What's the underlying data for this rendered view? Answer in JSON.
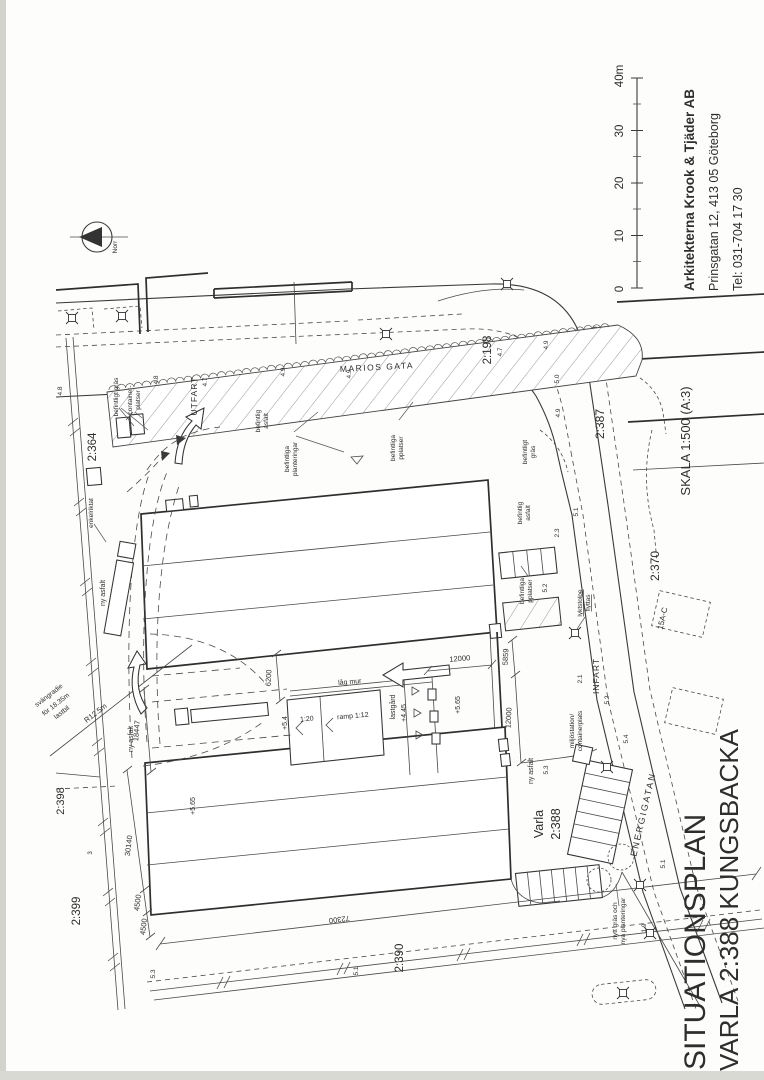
{
  "page": {
    "bg": "#fdfdfb",
    "ink": "#3a3a3a",
    "kind": "architectural site plan (scanned, rotated 90°)"
  },
  "scale_bar": {
    "unit_labels": [
      "0",
      "10",
      "20",
      "30",
      "40m"
    ],
    "length_m": 40
  },
  "texts": [
    {
      "n": "firm-name",
      "t": "Arkitekterna Krook & Tjäder AB",
      "x": 694,
      "y": 291,
      "r": -90,
      "s": 13.5,
      "a": "s",
      "w": 1
    },
    {
      "n": "firm-address",
      "t": "Prinsgatan 12,  413 05 Göteborg",
      "x": 718,
      "y": 291,
      "r": -90,
      "s": 12.5,
      "a": "s"
    },
    {
      "n": "firm-phone",
      "t": "Tel: 031-704 17 30",
      "x": 742,
      "y": 291,
      "r": -90,
      "s": 12.5,
      "a": "s"
    },
    {
      "n": "scale-note",
      "t": "SKALA 1:500 (A:3)",
      "x": 690,
      "y": 441,
      "r": -90,
      "s": 13
    },
    {
      "n": "title-line1",
      "t": "SITUATIONSPLAN",
      "x": 705,
      "y": 1070,
      "r": -90,
      "s": 30,
      "a": "s"
    },
    {
      "n": "title-line2",
      "t": "VARLA 2:388  KUNGSBACKA",
      "x": 738,
      "y": 1071,
      "r": -90,
      "s": 26,
      "a": "s"
    },
    {
      "n": "scalebar-0",
      "t": "0",
      "x": 623,
      "y": 289,
      "r": -90,
      "s": 11.5
    },
    {
      "n": "scalebar-10",
      "t": "10",
      "x": 623,
      "y": 236,
      "r": -90,
      "s": 11.5
    },
    {
      "n": "scalebar-20",
      "t": "20",
      "x": 623,
      "y": 183,
      "r": -90,
      "s": 11.5
    },
    {
      "n": "scalebar-30",
      "t": "30",
      "x": 623,
      "y": 131,
      "r": -90,
      "s": 11.5
    },
    {
      "n": "scalebar-40",
      "t": "40m",
      "x": 623,
      "y": 76,
      "r": -90,
      "s": 11.5
    },
    {
      "n": "north-label",
      "t": "Norr",
      "x": 117,
      "y": 247,
      "r": -90,
      "s": 6.5
    },
    {
      "n": "street-marios-gata",
      "t": "MARIOS GATA",
      "x": 340,
      "y": 372,
      "r": -3,
      "s": 8.5,
      "a": "s",
      "ls": 1.5
    },
    {
      "n": "street-energigatan",
      "t": "ENERGIGATAN",
      "x": 646,
      "y": 815,
      "r": -77,
      "s": 9,
      "ls": 2
    },
    {
      "n": "label-utfart",
      "t": "UTFART",
      "x": 197,
      "y": 396,
      "r": -90,
      "s": 8.5,
      "ls": 1
    },
    {
      "n": "label-infart",
      "t": "INFART",
      "x": 599,
      "y": 676,
      "r": -90,
      "s": 8.5,
      "ls": 1
    },
    {
      "n": "parcel-2364",
      "t": "2:364",
      "x": 96,
      "y": 447,
      "r": -90,
      "s": 11.5
    },
    {
      "n": "parcel-2198",
      "t": "2:198",
      "x": 491,
      "y": 350,
      "r": -90,
      "s": 11.5
    },
    {
      "n": "parcel-2387",
      "t": "2:387",
      "x": 604,
      "y": 424,
      "r": -90,
      "s": 12
    },
    {
      "n": "parcel-2370",
      "t": "2:370",
      "x": 659,
      "y": 566,
      "r": -90,
      "s": 12
    },
    {
      "n": "parcel-2398",
      "t": "2:398",
      "x": 64,
      "y": 801,
      "r": -90,
      "s": 11
    },
    {
      "n": "parcel-2399",
      "t": "2:399",
      "x": 80,
      "y": 911,
      "r": -90,
      "s": 11.5
    },
    {
      "n": "parcel-2390",
      "t": "2:390",
      "x": 403,
      "y": 958,
      "r": -90,
      "s": 11.5
    },
    {
      "n": "parcel-varla-1",
      "t": "Varla",
      "x": 543,
      "y": 824,
      "r": -90,
      "s": 12.5
    },
    {
      "n": "parcel-varla-2",
      "t": "2:388",
      "x": 560,
      "y": 824,
      "r": -90,
      "s": 12.5
    },
    {
      "n": "building-15ac",
      "t": "15A-C",
      "x": 665,
      "y": 619,
      "r": -77,
      "s": 8
    },
    {
      "n": "note-befintligt-gras-1",
      "t": "befintligt gräs",
      "x": 118,
      "y": 397,
      "r": -90,
      "s": 6.5
    },
    {
      "n": "note-container-1",
      "t": "container-",
      "x": 132,
      "y": 400,
      "r": -90,
      "s": 6.5
    },
    {
      "n": "note-container-2",
      "t": "platser",
      "x": 140,
      "y": 400,
      "r": -90,
      "s": 6.5
    },
    {
      "n": "note-bef-asfalt-1a",
      "t": "befintlig",
      "x": 260,
      "y": 421,
      "r": -90,
      "s": 6.5
    },
    {
      "n": "note-bef-asfalt-1b",
      "t": "asfalt",
      "x": 268,
      "y": 421,
      "r": -90,
      "s": 6.5
    },
    {
      "n": "note-bef-plant-1a",
      "t": "befintliga",
      "x": 289,
      "y": 459,
      "r": -90,
      "s": 6.5
    },
    {
      "n": "note-bef-plant-1b",
      "t": "planteringar",
      "x": 297,
      "y": 459,
      "r": -90,
      "s": 6.5
    },
    {
      "n": "note-bef-pplatser-1a",
      "t": "befintliga",
      "x": 395,
      "y": 448,
      "r": -90,
      "s": 6.5
    },
    {
      "n": "note-bef-pplatser-1b",
      "t": "pplatser",
      "x": 403,
      "y": 448,
      "r": -90,
      "s": 6.5
    },
    {
      "n": "note-befintligt-gras-2a",
      "t": "befintligt",
      "x": 527,
      "y": 452,
      "r": -90,
      "s": 6.5
    },
    {
      "n": "note-befintligt-gras-2b",
      "t": "gräs",
      "x": 535,
      "y": 452,
      "r": -90,
      "s": 6.5
    },
    {
      "n": "note-bef-asfalt-2a",
      "t": "befintlig",
      "x": 522,
      "y": 513,
      "r": -90,
      "s": 6.5
    },
    {
      "n": "note-bef-asfalt-2b",
      "t": "asfalt",
      "x": 530,
      "y": 513,
      "r": -90,
      "s": 6.5
    },
    {
      "n": "note-bef-pplatser-2a",
      "t": "befintliga",
      "x": 524,
      "y": 591,
      "r": -90,
      "s": 6.5
    },
    {
      "n": "note-bef-pplatser-2b",
      "t": "pplatser",
      "x": 532,
      "y": 591,
      "r": -90,
      "s": 6.5
    },
    {
      "n": "note-lyktstolpe-1",
      "t": "lyktstolpe",
      "x": 582,
      "y": 603,
      "r": -90,
      "s": 6.5,
      "u": 1
    },
    {
      "n": "note-lyktstolpe-2",
      "t": "flyttas",
      "x": 590,
      "y": 603,
      "r": -90,
      "s": 6.5,
      "u": 1
    },
    {
      "n": "note-miljostation-1",
      "t": "miljöstation/",
      "x": 574,
      "y": 731,
      "r": -90,
      "s": 6.5
    },
    {
      "n": "note-miljostation-2",
      "t": "containerplats",
      "x": 582,
      "y": 731,
      "r": -90,
      "s": 6.5
    },
    {
      "n": "note-nytt-gras-1",
      "t": "nytt gräs och",
      "x": 617,
      "y": 921,
      "r": -90,
      "s": 6.5
    },
    {
      "n": "note-nytt-gras-2",
      "t": "nya planteringar",
      "x": 625,
      "y": 921,
      "r": -90,
      "s": 6.5
    },
    {
      "n": "note-enkelriktat",
      "t": "enkelriktat",
      "x": 93,
      "y": 513,
      "r": -90,
      "s": 6.5
    },
    {
      "n": "note-ny-asfalt-1",
      "t": "ny asfalt",
      "x": 105,
      "y": 593,
      "r": -90,
      "s": 7
    },
    {
      "n": "note-ny-asfalt-2",
      "t": "ny asfalt",
      "x": 133,
      "y": 739,
      "r": -90,
      "s": 7
    },
    {
      "n": "note-ny-asfalt-3",
      "t": "ny asfalt",
      "x": 533,
      "y": 771,
      "r": -90,
      "s": 7
    },
    {
      "n": "note-lag-mur",
      "t": "låg mur",
      "x": 350,
      "y": 684,
      "r": -5,
      "s": 7
    },
    {
      "n": "note-ramp",
      "t": "ramp 1:12",
      "x": 353,
      "y": 718,
      "r": -5,
      "s": 7
    },
    {
      "n": "note-slope-120",
      "t": "1:20",
      "x": 307,
      "y": 721,
      "r": -5,
      "s": 7
    },
    {
      "n": "note-lastgard",
      "t": "lastgård",
      "x": 395,
      "y": 707,
      "r": -90,
      "s": 7
    },
    {
      "n": "level-445",
      "t": "+4.45",
      "x": 406,
      "y": 713,
      "r": -90,
      "s": 7
    },
    {
      "n": "level-565-a",
      "t": "+5.65",
      "x": 460,
      "y": 705,
      "r": -90,
      "s": 7
    },
    {
      "n": "level-54",
      "t": "+5.4",
      "x": 287,
      "y": 723,
      "r": -90,
      "s": 7
    },
    {
      "n": "level-565-b",
      "t": "+5.65",
      "x": 195,
      "y": 806,
      "r": -90,
      "s": 7
    },
    {
      "n": "note-svangradie-1",
      "t": "svängradie",
      "x": 50,
      "y": 697,
      "r": -38,
      "s": 6.8
    },
    {
      "n": "note-svangradie-2",
      "t": "för 18.35m",
      "x": 57,
      "y": 706,
      "r": -38,
      "s": 6.8
    },
    {
      "n": "note-svangradie-3",
      "t": "lastbil",
      "x": 63,
      "y": 714,
      "r": -38,
      "s": 6.8
    },
    {
      "n": "note-radius",
      "t": "R12.5m",
      "x": 97,
      "y": 715,
      "r": -38,
      "s": 7.5
    },
    {
      "n": "dim-6200",
      "t": "6200",
      "x": 271,
      "y": 678,
      "r": -87,
      "s": 7.5
    },
    {
      "n": "dim-5859",
      "t": "5859",
      "x": 508,
      "y": 657,
      "r": -87,
      "s": 7.5
    },
    {
      "n": "dim-12000-v",
      "t": "12000",
      "x": 511,
      "y": 718,
      "r": -87,
      "s": 7.5
    },
    {
      "n": "dim-12000-h",
      "t": "12000",
      "x": 460,
      "y": 661,
      "r": -5,
      "s": 7.5
    },
    {
      "n": "dim-18447",
      "t": "18447",
      "x": 139,
      "y": 731,
      "r": -85,
      "s": 7.5
    },
    {
      "n": "dim-30140",
      "t": "30140",
      "x": 131,
      "y": 846,
      "r": -83,
      "s": 7.5
    },
    {
      "n": "dim-4500-a",
      "t": "4500",
      "x": 140,
      "y": 903,
      "r": -83,
      "s": 7.5
    },
    {
      "n": "dim-4500-b",
      "t": "4500",
      "x": 146,
      "y": 927,
      "r": -83,
      "s": 7.5
    },
    {
      "n": "dim-72300",
      "t": "72300",
      "x": 339,
      "y": 917,
      "r": 173,
      "s": 7.5
    },
    {
      "n": "spot-48a",
      "t": "4.8",
      "x": 158,
      "y": 380,
      "r": -90,
      "s": 6.5
    },
    {
      "n": "spot-48b",
      "t": "4.8",
      "x": 62,
      "y": 391,
      "r": -90,
      "s": 6.5
    },
    {
      "n": "spot-47a",
      "t": "4.7",
      "x": 207,
      "y": 382,
      "r": -90,
      "s": 6.5
    },
    {
      "n": "spot-49a",
      "t": "4.9",
      "x": 285,
      "y": 372,
      "r": -90,
      "s": 6.5
    },
    {
      "n": "spot-49b",
      "t": "4.9",
      "x": 351,
      "y": 374,
      "r": -90,
      "s": 6.5
    },
    {
      "n": "spot-47b",
      "t": "4.7",
      "x": 502,
      "y": 352,
      "r": -90,
      "s": 6.5
    },
    {
      "n": "spot-49c",
      "t": "4.9",
      "x": 548,
      "y": 345,
      "r": -90,
      "s": 6.5
    },
    {
      "n": "spot-50",
      "t": "5.0",
      "x": 559,
      "y": 379,
      "r": -90,
      "s": 6.5
    },
    {
      "n": "spot-49d",
      "t": "4.9",
      "x": 560,
      "y": 413,
      "r": -90,
      "s": 6.5
    },
    {
      "n": "spot-51a",
      "t": "5.1",
      "x": 578,
      "y": 512,
      "r": -90,
      "s": 6.5
    },
    {
      "n": "spot-23",
      "t": "2.3",
      "x": 559,
      "y": 533,
      "r": -90,
      "s": 6.5
    },
    {
      "n": "spot-52a",
      "t": "5.2",
      "x": 547,
      "y": 588,
      "r": -90,
      "s": 6.5
    },
    {
      "n": "spot-52b",
      "t": "5.2",
      "x": 609,
      "y": 700,
      "r": -90,
      "s": 6.5
    },
    {
      "n": "spot-21",
      "t": "2.1",
      "x": 582,
      "y": 679,
      "r": -90,
      "s": 6.5
    },
    {
      "n": "spot-54",
      "t": "5.4",
      "x": 628,
      "y": 739,
      "r": -90,
      "s": 6.5
    },
    {
      "n": "spot-53a",
      "t": "5.3",
      "x": 548,
      "y": 770,
      "r": -90,
      "s": 6.5
    },
    {
      "n": "spot-53b",
      "t": "5.3",
      "x": 155,
      "y": 974,
      "r": -90,
      "s": 6.5
    },
    {
      "n": "spot-51b",
      "t": "5.1",
      "x": 358,
      "y": 971,
      "r": -90,
      "s": 6.5
    },
    {
      "n": "spot-51c",
      "t": "5.1",
      "x": 665,
      "y": 864,
      "r": -90,
      "s": 6.5
    },
    {
      "n": "spot-19",
      "t": "1.9",
      "x": 646,
      "y": 928,
      "r": -90,
      "s": 6.5
    },
    {
      "n": "spot-3",
      "t": "3",
      "x": 92,
      "y": 853,
      "r": -90,
      "s": 6
    }
  ],
  "lampposts": [
    [
      72,
      318
    ],
    [
      122,
      316
    ],
    [
      386,
      334
    ],
    [
      507,
      284
    ],
    [
      575,
      633
    ],
    [
      607,
      767
    ],
    [
      640,
      885
    ],
    [
      650,
      933
    ],
    [
      623,
      993
    ]
  ],
  "scallop": {
    "x1": 109,
    "y1": 390,
    "x2": 617,
    "y2": 326,
    "r": 4.2
  }
}
